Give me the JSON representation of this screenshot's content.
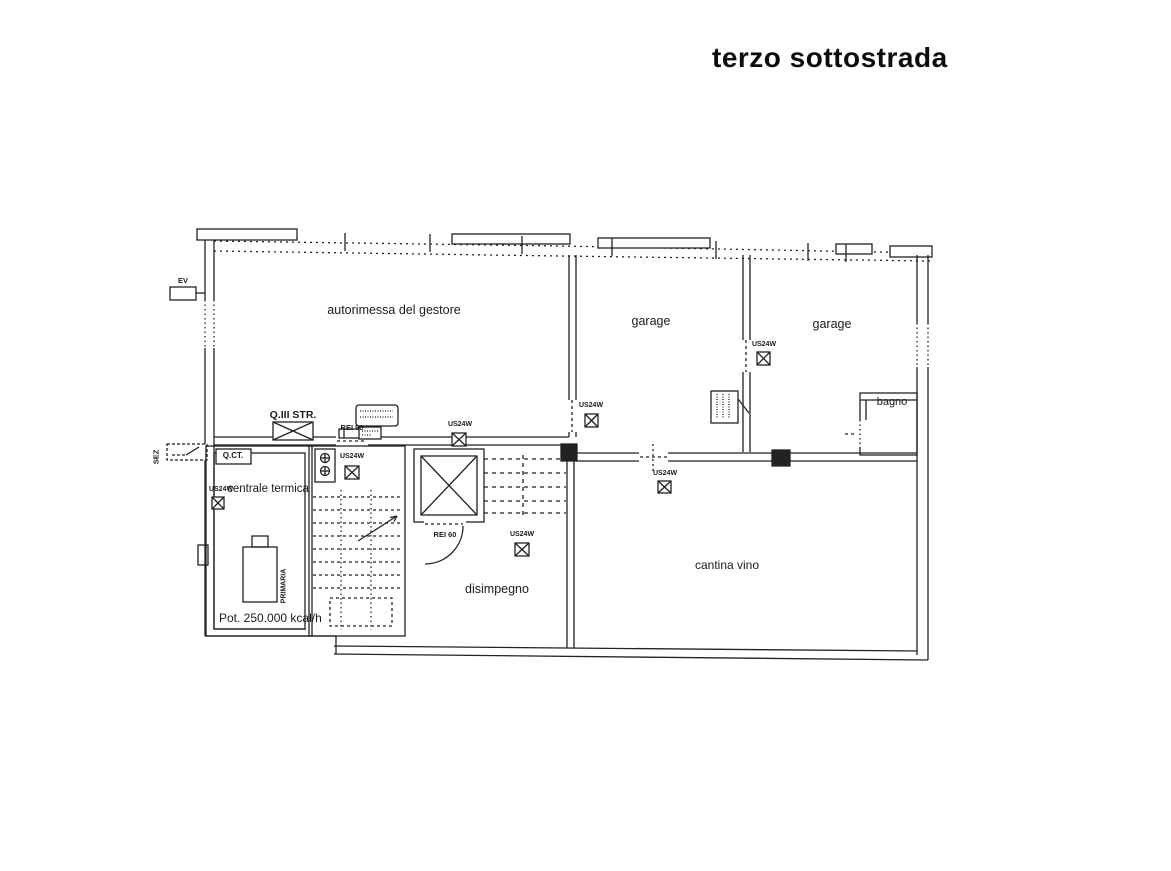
{
  "title": "terzo sottostrada",
  "rooms": {
    "autorimessa": "autorimessa del gestore",
    "garage": "garage",
    "bagno": "bagno",
    "centrale_termica": "centrale termica",
    "disimpegno": "disimpegno",
    "cantina": "cantina vino"
  },
  "labels": {
    "ev": "EV",
    "sez": "SEZ",
    "qct": "Q.CT.",
    "qiii_str": "Q.III STR.",
    "rei90": "REI 90",
    "rei60": "REI 60",
    "us24w": "US24W",
    "primaria": "PRIMARIA",
    "potenza": "Pot. 250.000 kcal/h"
  },
  "colors": {
    "ink": "#222222",
    "paper": "#ffffff"
  }
}
